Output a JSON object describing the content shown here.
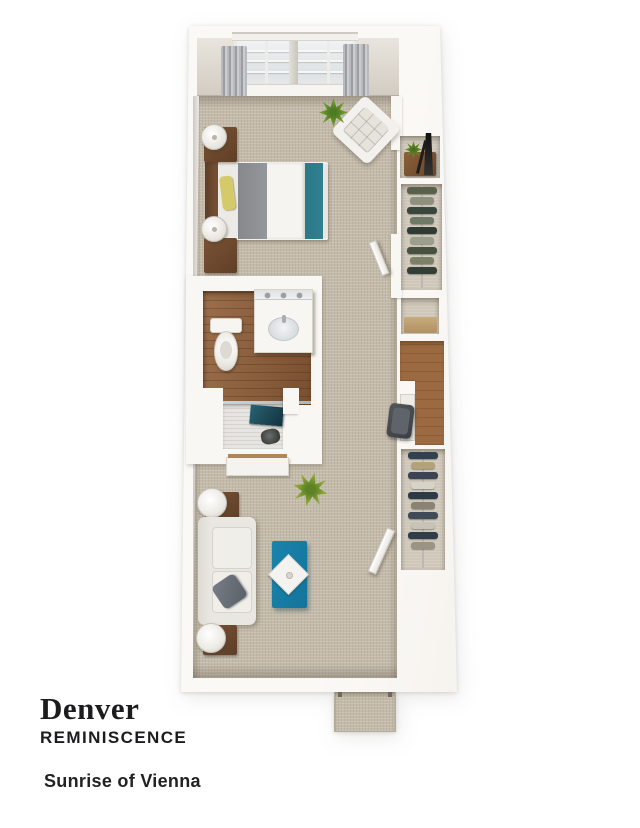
{
  "caption": {
    "title": "Denver",
    "program": "REMINISCENCE",
    "community": "Sunrise of Vienna"
  },
  "palette": {
    "wall": "#f9f7f4",
    "carpet": "#c4bbaa",
    "bathroom_wood": "#8a5a36",
    "desk_wood": "#9c6a40",
    "furniture_wood": "#7a5234",
    "coffee_table_teal": "#1a84ac",
    "bed_runner_teal": "#2d7f8f",
    "shower_teal": "#1c4552",
    "blanket_gray": "#8d9094",
    "pillow_yellow": "#d5ca6a",
    "plant_green": "#6f9a2f",
    "curtain_gray": "#9a9da1",
    "text_color": "#1c1c1e"
  },
  "closets": {
    "bedroom": [
      "#59614c",
      "#8d907c",
      "#39463c",
      "#6d7a66",
      "#2f3b33",
      "#9aa08c",
      "#46523f",
      "#7b8168",
      "#333f36"
    ],
    "living": [
      "#33404e",
      "#b3a27a",
      "#3c4452",
      "#d6d3c8",
      "#2e3947",
      "#8a8272",
      "#414b58",
      "#c7c3b6",
      "#303c49",
      "#9b9384"
    ]
  }
}
